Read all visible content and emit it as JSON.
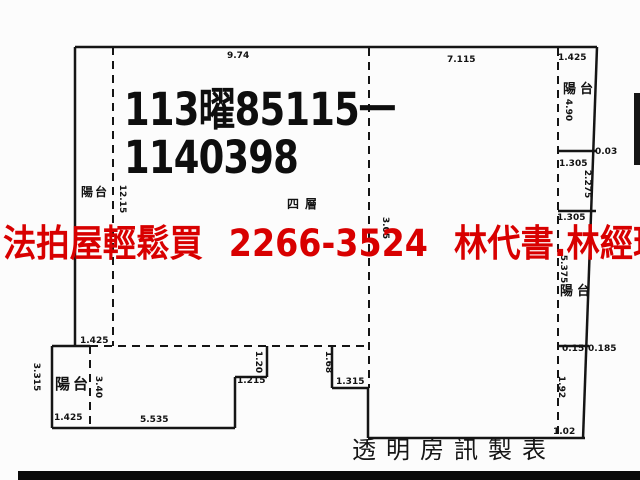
{
  "document": {
    "case_number_line1": "113曜85115一",
    "case_number_line2": "1140398",
    "ad_banner": "法拍屋輕鬆買 2266-3524 林代書.林經理",
    "footer_credit": "透明房訊製表",
    "floor_label": "四層"
  },
  "rooms": {
    "left_balcony": "陽台",
    "top_right_balcony": "陽台",
    "mid_right_balcony": "陽台",
    "bottom_left_balcony": "陽台"
  },
  "measurements": {
    "top_width_left": "9.74",
    "top_width_right": "7.115",
    "right_balcony_width": "1.425",
    "right_balcony_height": "4.90",
    "right_offset_top": "0.03",
    "right_section2_width": "1.305",
    "right_section2_height": "2.275",
    "right_section3_width": "1.305",
    "right_section3_height": "5.375",
    "right_offset_mid_a": "0.15",
    "right_offset_mid_b": "0.185",
    "right_section4_height": "1.92",
    "bottom_right_width": "1.02",
    "left_strip_height": "12.15",
    "center_height": "3.05",
    "bl_top_width": "1.425",
    "bl_left_height": "3.315",
    "bl_inner_height": "3.40",
    "bl_bottom_width": "1.425",
    "bottom_width": "5.535",
    "notch1_height": "1.20",
    "notch1_width": "1.215",
    "notch2_height": "1.68",
    "notch2_width": "1.315"
  },
  "colors": {
    "wall_line": "#151515",
    "banner_red": "#d80000",
    "text_black": "#121212",
    "background": "#fcfcfc"
  }
}
